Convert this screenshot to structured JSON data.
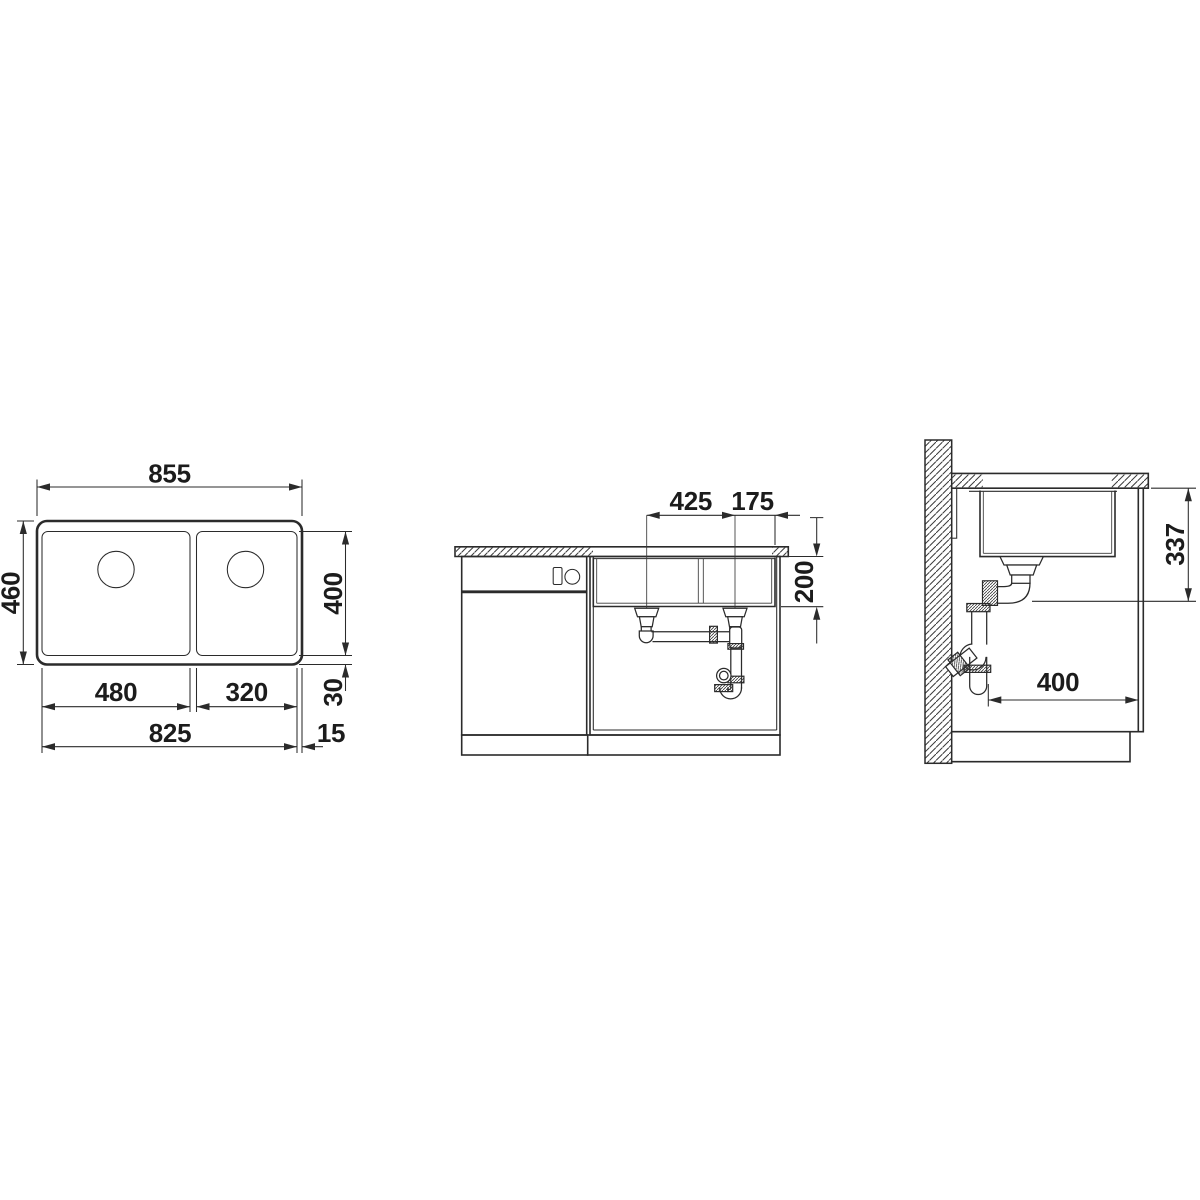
{
  "drawing": {
    "type": "sink installation technical drawing",
    "background_color": "#ffffff",
    "line_color": "#2b2b2b",
    "text_color": "#1c1c1c",
    "views": {
      "top": {
        "name": "top view (plan of double-bowl sink)"
      },
      "front": {
        "name": "front view (cabinet elevation with drain plumbing)"
      },
      "side": {
        "name": "side view (wall section with trap)"
      }
    }
  },
  "dims": {
    "top": {
      "total_width": "855",
      "total_depth": "460",
      "bowl_depth": "400",
      "rim_back": "30",
      "bowl_left_width": "480",
      "bowl_right_width": "320",
      "bowls_span": "825",
      "rim_side": "15"
    },
    "front": {
      "drain_spacing": "425",
      "drain_edge_offset": "175",
      "bowl_height": "200"
    },
    "side": {
      "outlet_height": "337",
      "front_clearance": "400"
    }
  }
}
